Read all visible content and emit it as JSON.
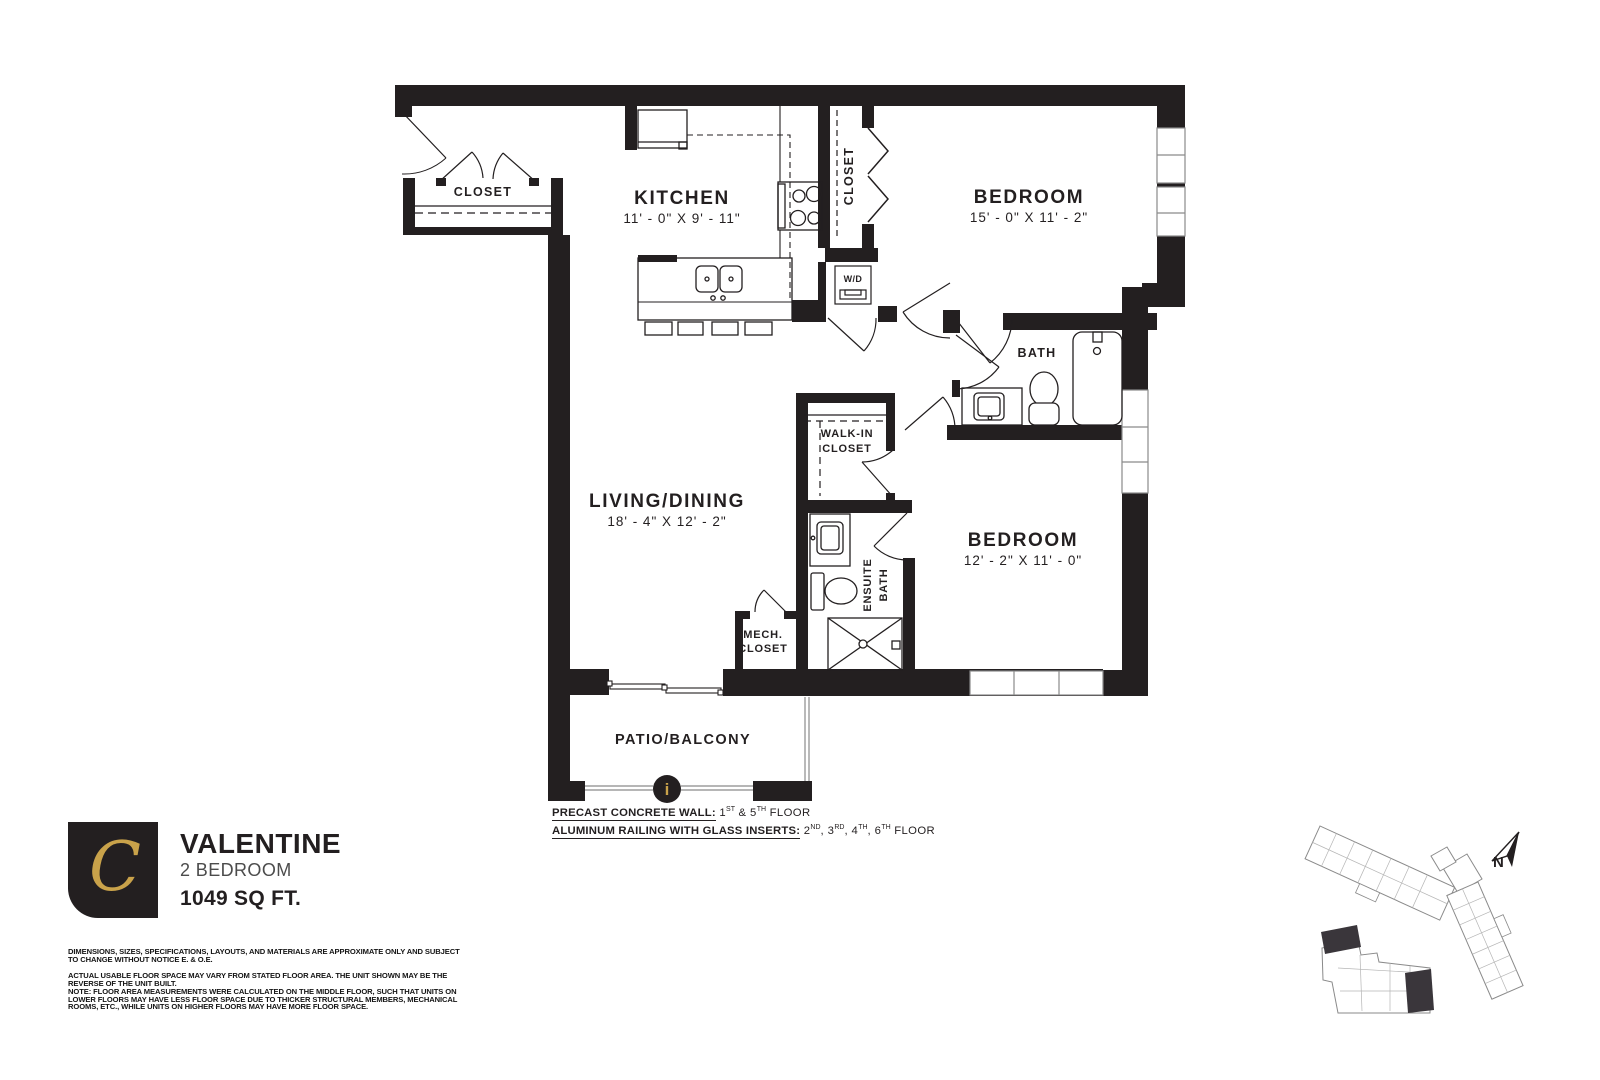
{
  "plan": {
    "labels": {
      "closet_entry": "CLOSET",
      "kitchen_name": "KITCHEN",
      "kitchen_dims": "11' - 0\" X 9' - 11\"",
      "bedroom1_name": "BEDROOM",
      "bedroom1_dims": "15' - 0\" X 11' - 2\"",
      "closet_bed1": "CLOSET",
      "wd": "W/D",
      "bath": "BATH",
      "walkin_line1": "WALK-IN",
      "walkin_line2": "CLOSET",
      "living_name": "LIVING/DINING",
      "living_dims": "18' - 4\" X 12' - 2\"",
      "ensuite_line1": "ENSUITE",
      "ensuite_line2": "BATH",
      "bedroom2_name": "BEDROOM",
      "bedroom2_dims": "12' - 2\" X 11' - 0\"",
      "mech_line1": "MECH.",
      "mech_line2": "CLOSET",
      "patio": "PATIO/BALCONY",
      "info_glyph": "i"
    },
    "notes": {
      "n1_label": "PRECAST CONCRETE WALL:",
      "n1_value": [
        {
          "t": " 1"
        },
        {
          "sup": "ST"
        },
        {
          "t": " & 5"
        },
        {
          "sup": "TH"
        },
        {
          "t": " FLOOR"
        }
      ],
      "n2_label": "ALUMINUM RAILING WITH GLASS INSERTS:",
      "n2_value": [
        {
          "t": " 2"
        },
        {
          "sup": "ND"
        },
        {
          "t": ", 3"
        },
        {
          "sup": "RD"
        },
        {
          "t": ", 4"
        },
        {
          "sup": "TH"
        },
        {
          "t": ", 6"
        },
        {
          "sup": "TH"
        },
        {
          "t": " FLOOR"
        }
      ]
    }
  },
  "branding": {
    "logo_letter": "C",
    "unit_name": "VALENTINE",
    "unit_type": "2 BEDROOM",
    "unit_area": "1049 SQ FT."
  },
  "disclaimer": {
    "p1": "DIMENSIONS, SIZES, SPECIFICATIONS, LAYOUTS, AND MATERIALS ARE APPROXIMATE ONLY AND SUBJECT TO CHANGE WITHOUT NOTICE E. & O.E.",
    "p2": "ACTUAL USABLE FLOOR SPACE MAY VARY FROM STATED FLOOR AREA. THE UNIT SHOWN MAY BE THE REVERSE OF THE UNIT BUILT.\nNOTE: FLOOR AREA MEASUREMENTS WERE CALCULATED ON THE MIDDLE FLOOR, SUCH THAT UNITS ON LOWER FLOORS MAY HAVE LESS FLOOR SPACE DUE TO THICKER STRUCTURAL MEMBERS, MECHANICAL ROOMS, ETC., WHILE UNITS ON HIGHER FLOORS MAY HAVE MORE FLOOR SPACE."
  },
  "keyplan": {
    "north_label": "N"
  },
  "colors": {
    "ink": "#231f20",
    "gold": "#c9a24a"
  }
}
